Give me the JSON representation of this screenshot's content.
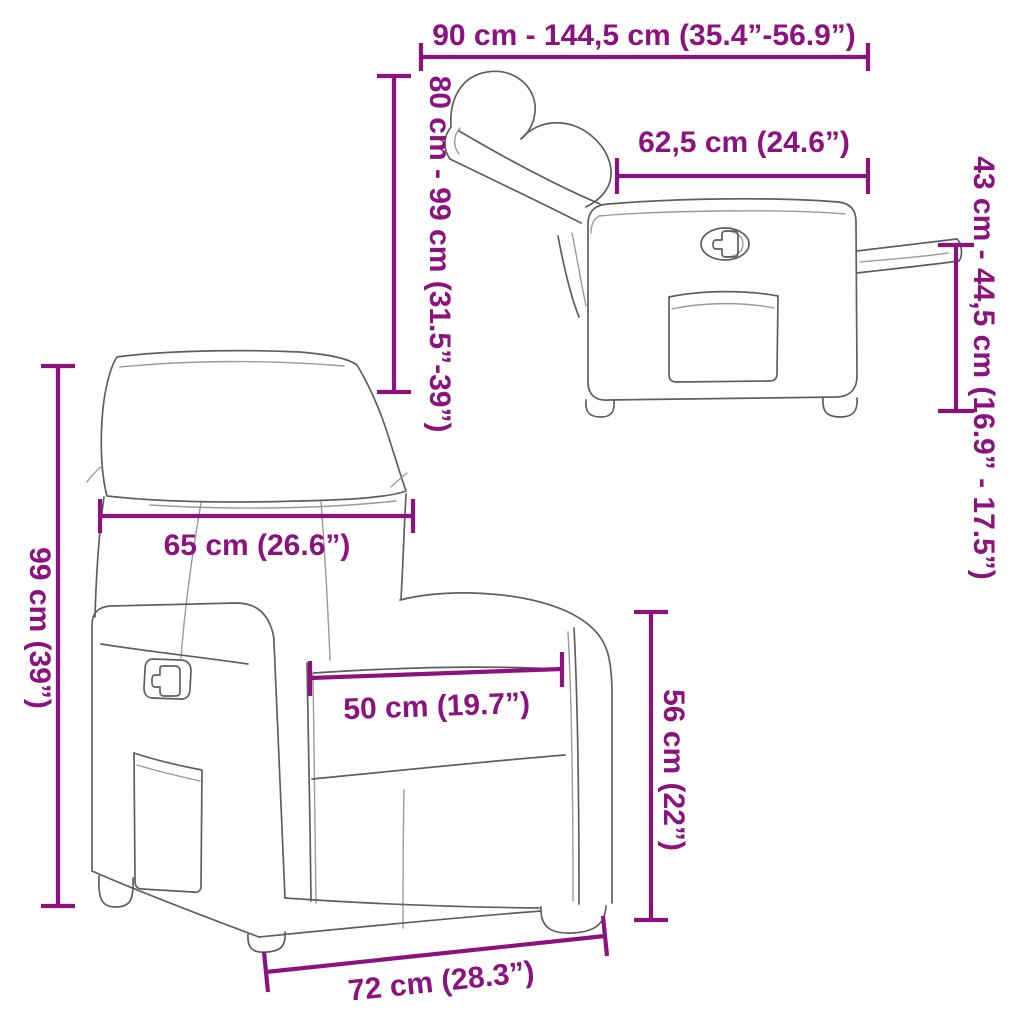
{
  "colors": {
    "dimension_accent": "#8C127F",
    "outline_main": "#5f5f5f",
    "outline_light": "#9a9a9a",
    "background": "#ffffff"
  },
  "figure": {
    "dimensions": [
      {
        "id": "overall-depth-range",
        "label": "90 cm - 144,5 cm (35.4”-56.9”)"
      },
      {
        "id": "body-depth",
        "label": "62,5 cm (24.6”)"
      },
      {
        "id": "footrest-height-range",
        "label": "43 cm - 44,5 cm (16.9” - 17.5”)"
      },
      {
        "id": "height-reclined-range",
        "label": "80 cm - 99 cm (31.5”-39”)"
      },
      {
        "id": "backrest-width",
        "label": "65 cm (26.6”)"
      },
      {
        "id": "height-upright",
        "label": "99 cm (39”)"
      },
      {
        "id": "seat-width",
        "label": "50 cm (19.7”)"
      },
      {
        "id": "armrest-height",
        "label": "56 cm (22”)"
      },
      {
        "id": "base-width",
        "label": "72 cm (28.3”)"
      }
    ]
  }
}
